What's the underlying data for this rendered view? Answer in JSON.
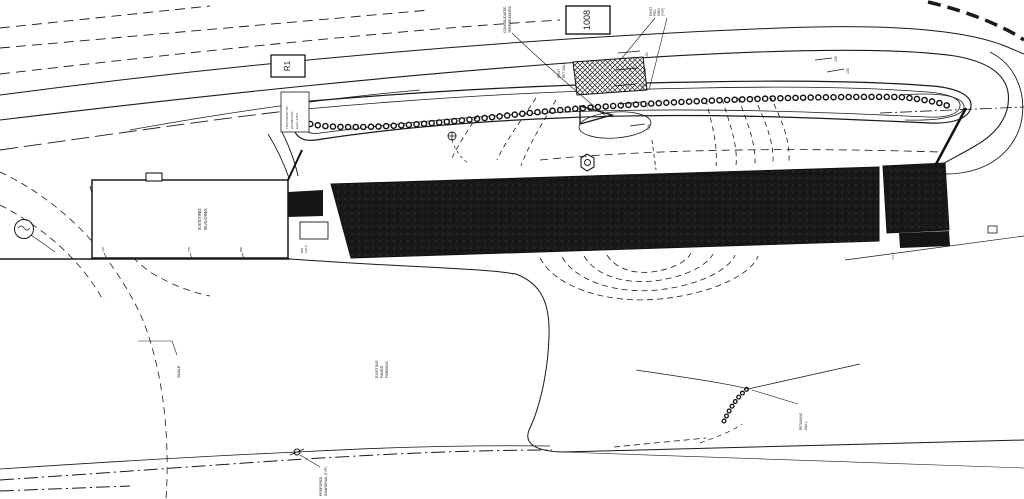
{
  "colors": {
    "ink": "#1a1a1a",
    "paper": "#ffffff",
    "building_fill": "#161616"
  },
  "labels": {
    "route_box": "R1",
    "building_box": "1008",
    "consolidated": [
      "CONSOLIDATED",
      "TREE REMOVED"
    ],
    "ped_xing": [
      "EXIST",
      "PED",
      "XING",
      "(TYP)"
    ],
    "ret_wall_top": [
      "EXIST",
      "RET WALL"
    ],
    "note_box": [
      "TW IN ROOT OF",
      "2% MIN PVC",
      "ELEV 125.0"
    ],
    "contours": {
      "s1": "130",
      "s2": "131",
      "s3": "132",
      "s4": "133",
      "low": "124",
      "r1": "132",
      "r2": "133"
    },
    "existing_building": [
      "EXISTING",
      "BUILDING"
    ],
    "wall_tags": [
      "TW",
      "TW",
      "BW"
    ],
    "divider": [
      "BW",
      "160.0"
    ],
    "annex_elev": "172.1",
    "interior_mark": "B",
    "swale": "SWALE",
    "parking": [
      "EXISTING",
      "PAVED",
      "PARKING"
    ],
    "retaining_wall": [
      "RETAINING",
      "WALL"
    ],
    "proposed_guardrail": [
      "PROPOSED",
      "GUARDRAIL (TYP)"
    ]
  }
}
